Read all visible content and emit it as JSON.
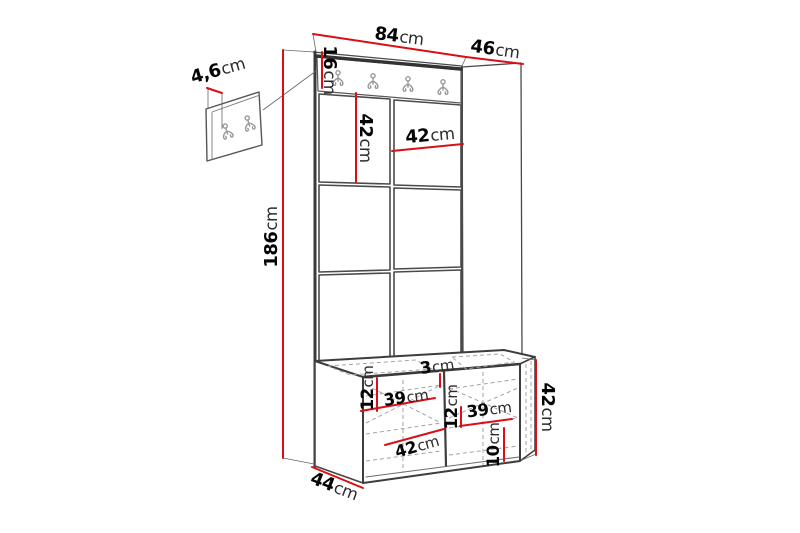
{
  "diagram": {
    "kind": "furniture dimension drawing",
    "subject": "hallway unit with coat-hook rail, padded wall panels and storage bench, plus separate small hook panel",
    "rail_hook_count": 4,
    "small_panel_hook_count": 2,
    "colors": {
      "dimension_line": "#d90f16",
      "outline": "#3d3d3d",
      "hidden_edge": "#a3a3a3",
      "hook": "#9a9a9a",
      "background": "#ffffff",
      "label_number": "#050505",
      "label_unit": "#2b2b2b"
    }
  },
  "labels": {
    "width_total": {
      "value": "84",
      "unit": "cm"
    },
    "depth_top": {
      "value": "46",
      "unit": "cm"
    },
    "panel_thickness": {
      "value": "4,6",
      "unit": "cm"
    },
    "rail_height": {
      "value": "16",
      "unit": "cm"
    },
    "height_total": {
      "value": "186",
      "unit": "cm"
    },
    "panel_height": {
      "value": "42",
      "unit": "cm"
    },
    "panel_width": {
      "value": "42",
      "unit": "cm"
    },
    "seat_height_left": {
      "value": "12",
      "unit": "cm"
    },
    "shelf_width_left": {
      "value": "39",
      "unit": "cm"
    },
    "divider_width": {
      "value": "3",
      "unit": "cm"
    },
    "seat_height_right": {
      "value": "12",
      "unit": "cm"
    },
    "shelf_width_right": {
      "value": "39",
      "unit": "cm"
    },
    "base_height": {
      "value": "10",
      "unit": "cm"
    },
    "bench_diagonal": {
      "value": "42",
      "unit": "cm"
    },
    "bench_height": {
      "value": "42",
      "unit": "cm"
    },
    "bench_depth": {
      "value": "44",
      "unit": "cm"
    }
  }
}
